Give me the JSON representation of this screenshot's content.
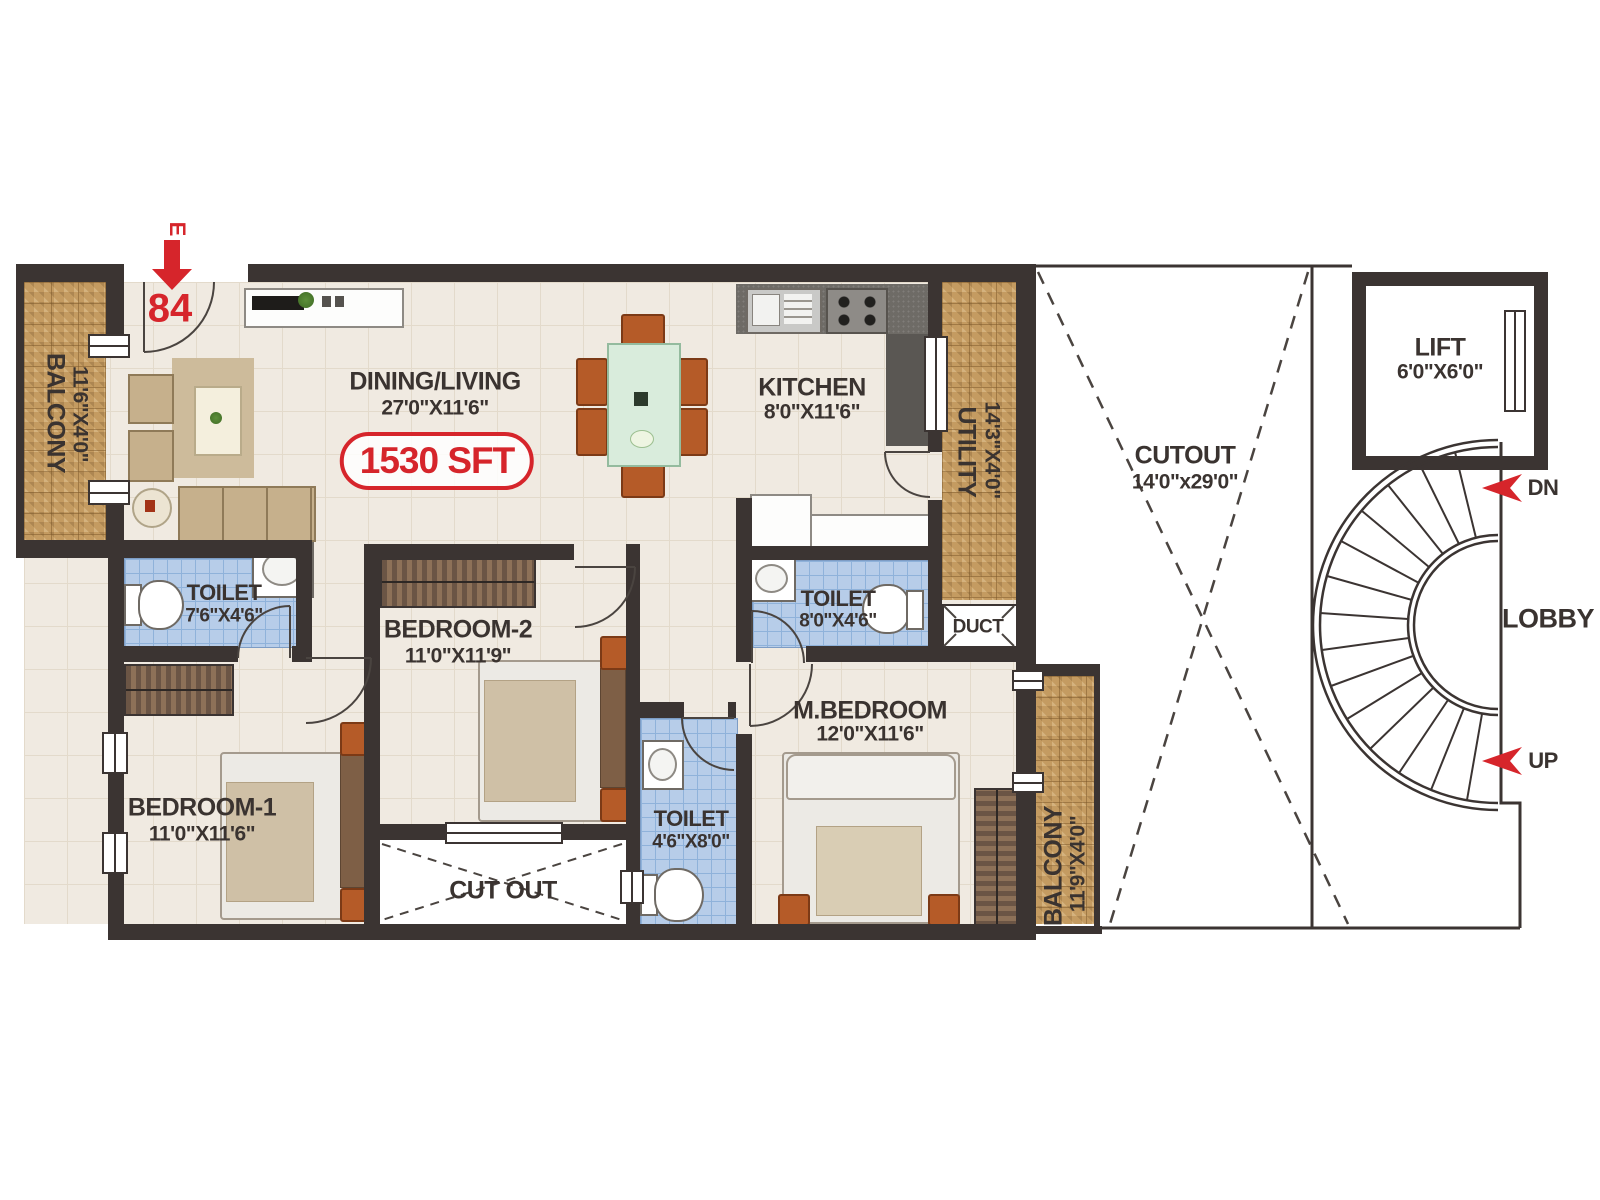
{
  "unit": {
    "number": "84",
    "entry_marker": "E"
  },
  "area_stamp": "1530 SFT",
  "rooms": {
    "balcony_left": {
      "name": "BALCONY",
      "size": "11'6\"X4'0\""
    },
    "dining_living": {
      "name": "DINING/LIVING",
      "size": "27'0\"X11'6\""
    },
    "kitchen": {
      "name": "KITCHEN",
      "size": "8'0\"X11'6\""
    },
    "utility": {
      "name": "UTILITY",
      "size": "14'3\"X4'0\""
    },
    "toilet_common": {
      "name": "TOILET",
      "size": "7'6\"X4'6\""
    },
    "bedroom_2": {
      "name": "BEDROOM-2",
      "size": "11'0\"X11'9\""
    },
    "toilet_attached": {
      "name": "TOILET",
      "size": "8'0\"X4'6\""
    },
    "duct": {
      "name": "DUCT"
    },
    "m_bedroom": {
      "name": "M.BEDROOM",
      "size": "12'0\"X11'6\""
    },
    "bedroom_1": {
      "name": "BEDROOM-1",
      "size": "11'0\"X11'6\""
    },
    "toilet_master": {
      "name": "TOILET",
      "size": "4'6\"X8'0\""
    },
    "cut_out_small": {
      "name": "CUT OUT"
    },
    "balcony_bottom": {
      "name": "BALCONY",
      "size": "11'9\"X4'0\""
    },
    "cutout_large": {
      "name": "CUTOUT",
      "size": "14'0\"x29'0\""
    },
    "lift": {
      "name": "LIFT",
      "size": "6'0\"X6'0\""
    },
    "lobby": {
      "name": "LOBBY"
    }
  },
  "stairs": {
    "down_label": "DN",
    "up_label": "UP"
  },
  "colors": {
    "accent_red": "#d6252b",
    "wall": "#3b3432",
    "tile_blue": "#b7cde9",
    "tile_brown": "#c49b61"
  }
}
